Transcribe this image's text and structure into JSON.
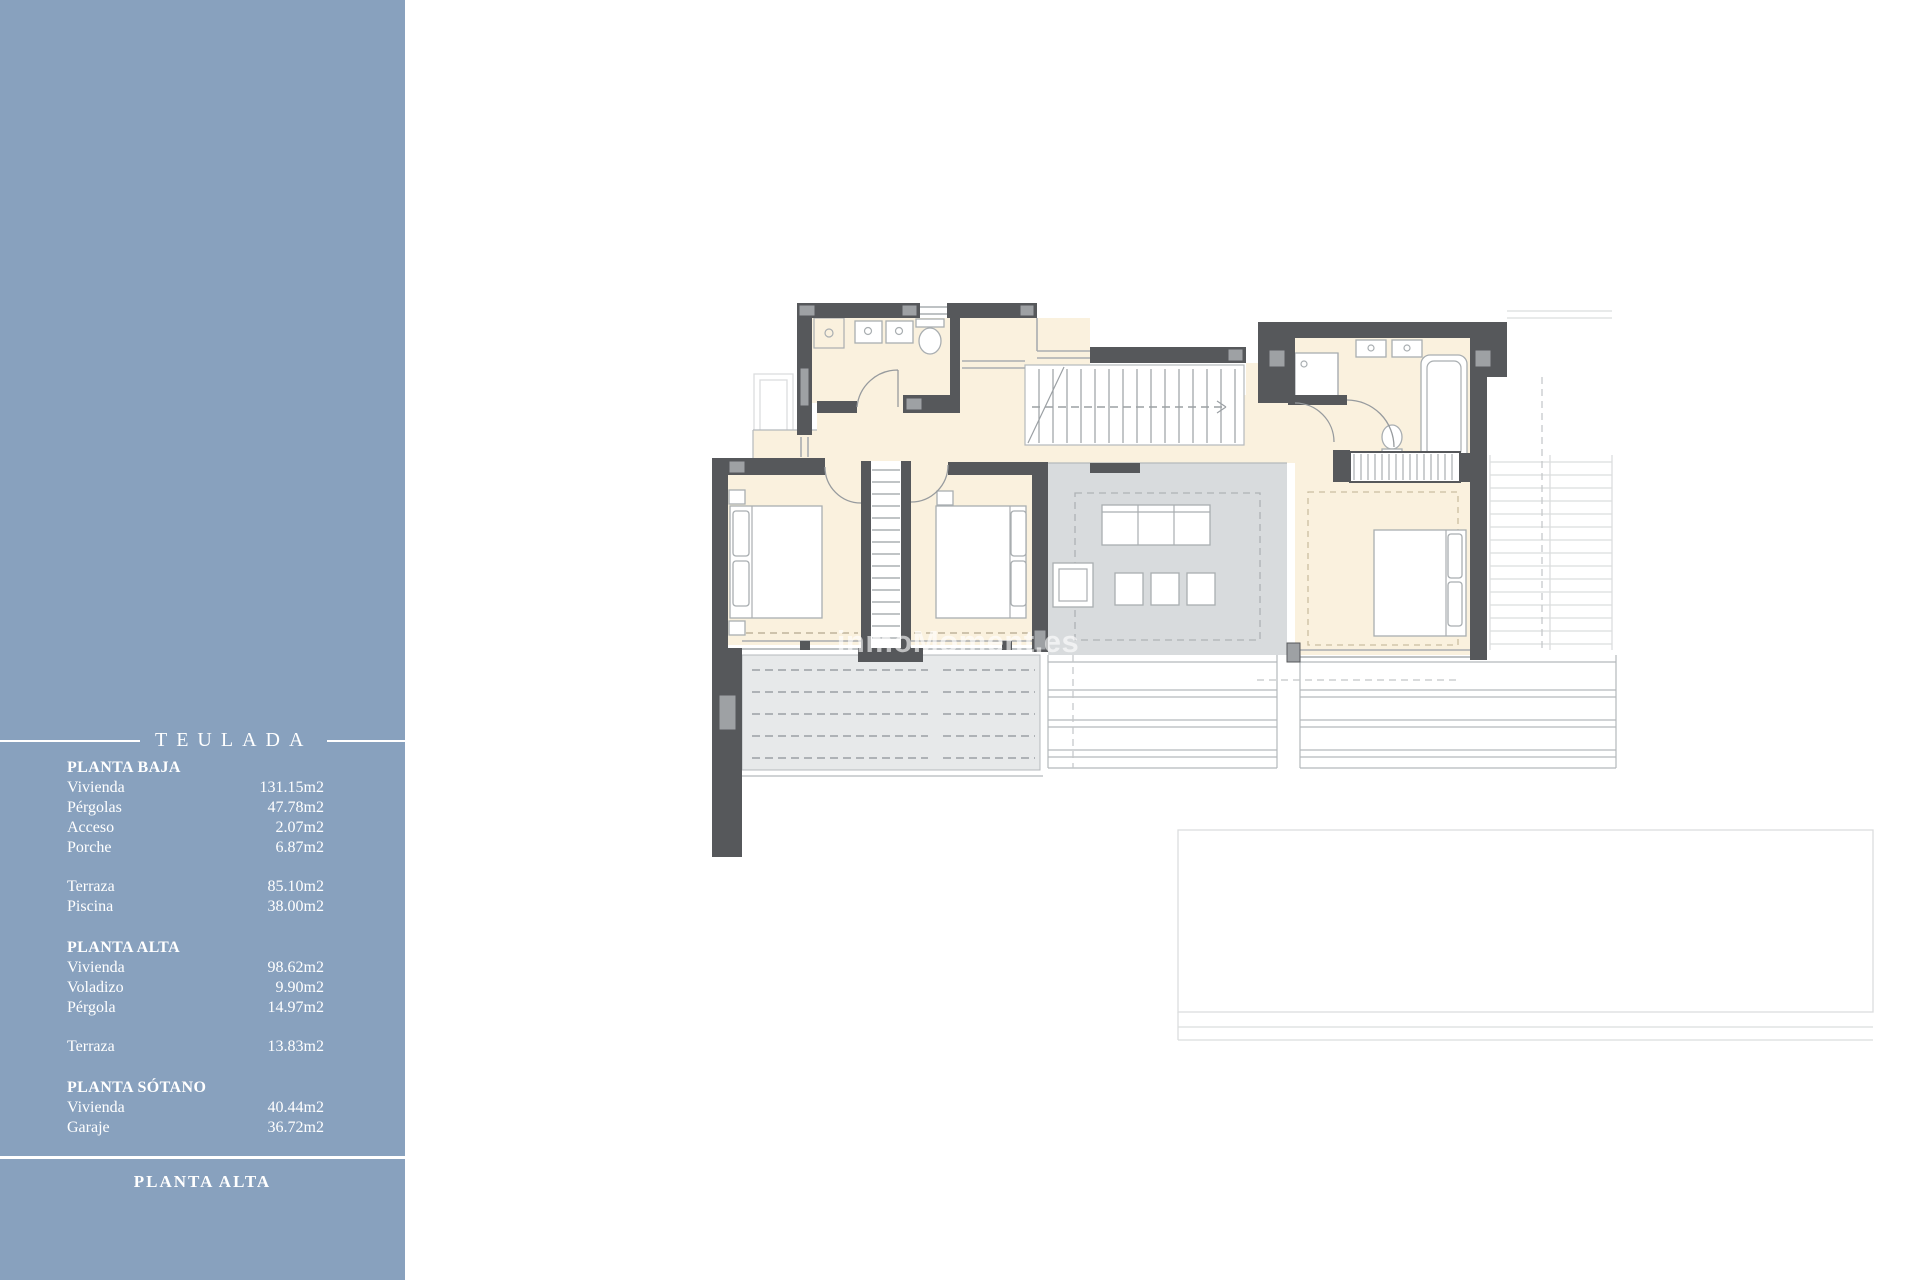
{
  "page": {
    "background": "#FFFFFF"
  },
  "sidebar": {
    "background_color": "#88A1BE",
    "text_color": "#FFFFFF",
    "title": "TEULADA",
    "footer_label": "PLANTA ALTA",
    "sections": [
      {
        "heading": "PLANTA BAJA",
        "groups": [
          [
            {
              "label": "Vivienda",
              "value": "131.15m2"
            },
            {
              "label": "Pérgolas",
              "value": "47.78m2"
            },
            {
              "label": "Acceso",
              "value": "2.07m2"
            },
            {
              "label": "Porche",
              "value": "6.87m2"
            }
          ],
          [
            {
              "label": "Terraza",
              "value": "85.10m2"
            },
            {
              "label": "Piscina",
              "value": "38.00m2"
            }
          ]
        ]
      },
      {
        "heading": "PLANTA ALTA",
        "groups": [
          [
            {
              "label": "Vivienda",
              "value": "98.62m2"
            },
            {
              "label": "Voladizo",
              "value": "9.90m2"
            },
            {
              "label": "Pérgola",
              "value": "14.97m2"
            }
          ],
          [
            {
              "label": "Terraza",
              "value": "13.83m2"
            }
          ]
        ]
      },
      {
        "heading": "PLANTA SÓTANO",
        "groups": [
          [
            {
              "label": "Vivienda",
              "value": "40.44m2"
            },
            {
              "label": "Garaje",
              "value": "36.72m2"
            }
          ]
        ]
      }
    ]
  },
  "floor_plan": {
    "watermark": "inmoMoment.es",
    "floor_shown": "PLANTA ALTA",
    "colors": {
      "wall": "#56585B",
      "room_fill": "#FAF1DE",
      "living_fill": "#D8DBDD",
      "terrace_fill": "#E7E9EA",
      "sidebar": "#88A1BE"
    }
  }
}
